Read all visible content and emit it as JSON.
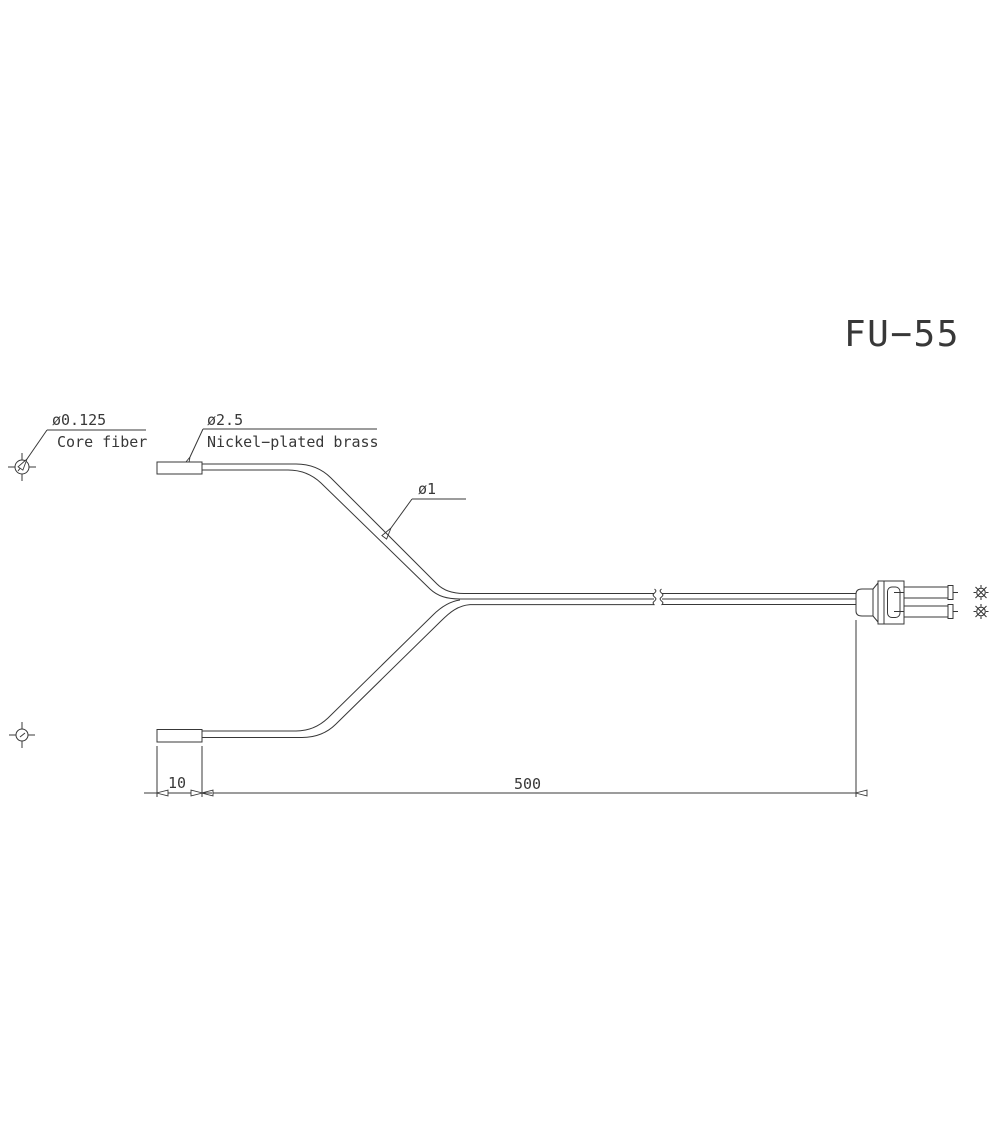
{
  "title": "FU−55",
  "callouts": {
    "core_fiber": {
      "dia": "ø0.125",
      "name": "Core fiber"
    },
    "ferrule": {
      "dia": "ø2.5",
      "material": "Nickel−plated brass"
    },
    "cable": {
      "dia": "ø1"
    }
  },
  "dimensions": {
    "ferrule_length": "10",
    "cable_length": "500"
  },
  "colors": {
    "line": "#383838",
    "background": "#ffffff"
  }
}
